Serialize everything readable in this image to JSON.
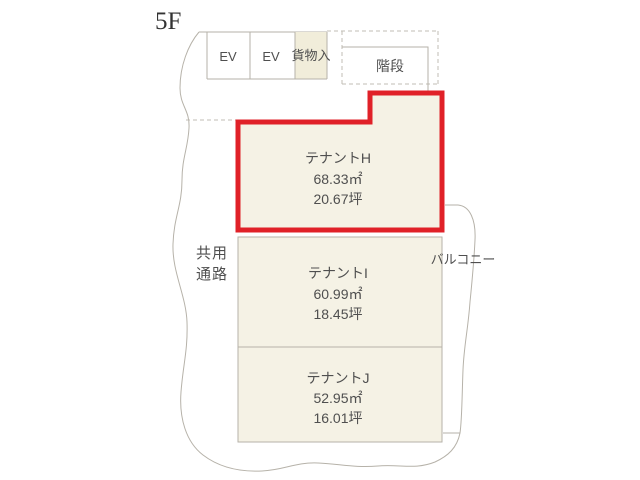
{
  "floor_label": "5F",
  "facilities": {
    "elevator1": "EV",
    "elevator2": "EV",
    "cargo": "貨物入",
    "stairs": "階段"
  },
  "corridor": {
    "line1": "共用",
    "line2": "通路"
  },
  "balcony_label": "バルコニー",
  "tenants": [
    {
      "name": "テナントH",
      "area_sqm": "68.33㎡",
      "area_tsubo": "20.67坪",
      "highlighted": true
    },
    {
      "name": "テナントI",
      "area_sqm": "60.99㎡",
      "area_tsubo": "18.45坪",
      "highlighted": false
    },
    {
      "name": "テナントJ",
      "area_sqm": "52.95㎡",
      "area_tsubo": "16.01坪",
      "highlighted": false
    }
  ],
  "colors": {
    "highlight_border": "#e02128",
    "room_fill": "#f5f2e5",
    "cargo_fill": "#f1edda",
    "line": "#b6b2a9",
    "text": "#4f4f4f"
  }
}
